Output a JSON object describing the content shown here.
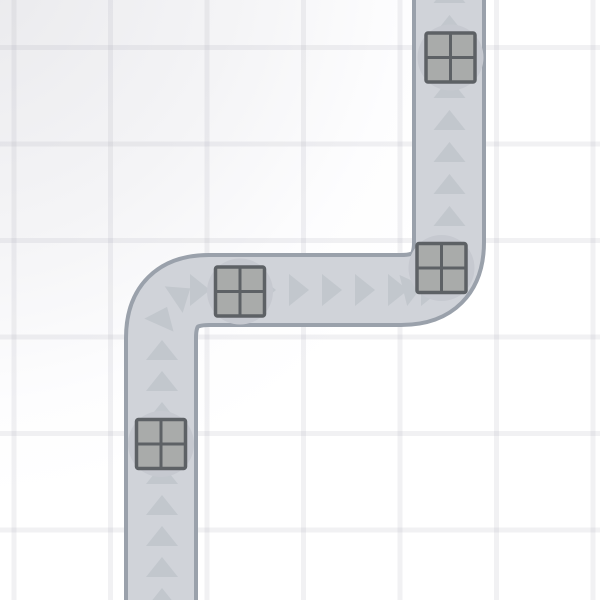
{
  "scene": {
    "title": "tower-defense-road-map",
    "width": 600,
    "height": 600,
    "colors": {
      "background": "#ffffff",
      "background_corner_tint": "#ebebee",
      "grid_line": "rgba(167,171,182,0.16)",
      "road_fill": "#d0d3d9",
      "road_border": "#9aa1ab",
      "arrow": "#c2c7cd",
      "pad_circle": "#c6c9d0",
      "crate_fill": "#a9abaa",
      "crate_border": "#5d6165"
    },
    "grid": {
      "offset_x": 14,
      "offset_y": 47.5,
      "spacing": 96.5,
      "line_width": 5
    },
    "road": {
      "centerline": "M 161 612 L 161 338 Q 161 290 209 290 L 401 290 Q 449 290 449 242 L 449 -12",
      "surface_width": 66,
      "border_width": 74,
      "corner_radius": 48,
      "flow": "up-right-up"
    },
    "arrows": {
      "base": 32,
      "height": 20,
      "items": [
        {
          "x": 162,
          "y": 598,
          "rot": 0
        },
        {
          "x": 162,
          "y": 567,
          "rot": 0
        },
        {
          "x": 162,
          "y": 536,
          "rot": 0
        },
        {
          "x": 162,
          "y": 505,
          "rot": 0
        },
        {
          "x": 162,
          "y": 474,
          "rot": 0
        },
        {
          "x": 162,
          "y": 443,
          "rot": 0
        },
        {
          "x": 162,
          "y": 412,
          "rot": 0
        },
        {
          "x": 162,
          "y": 381,
          "rot": 0
        },
        {
          "x": 162,
          "y": 350,
          "rot": 0
        },
        {
          "x": 163,
          "y": 316,
          "rot": 24
        },
        {
          "x": 182,
          "y": 294,
          "rot": 56
        },
        {
          "x": 200,
          "y": 290,
          "rot": 90
        },
        {
          "x": 233,
          "y": 290,
          "rot": 90
        },
        {
          "x": 266,
          "y": 290,
          "rot": 90
        },
        {
          "x": 299,
          "y": 290,
          "rot": 90
        },
        {
          "x": 332,
          "y": 290,
          "rot": 90
        },
        {
          "x": 365,
          "y": 290,
          "rot": 90
        },
        {
          "x": 398,
          "y": 290,
          "rot": 90
        },
        {
          "x": 431,
          "y": 290,
          "rot": 90
        },
        {
          "x": 413,
          "y": 288,
          "rot": 76
        },
        {
          "x": 440,
          "y": 271,
          "rot": 40
        },
        {
          "x": 449.5,
          "y": 248,
          "rot": 0
        },
        {
          "x": 449.5,
          "y": 216,
          "rot": 0
        },
        {
          "x": 449.5,
          "y": 184,
          "rot": 0
        },
        {
          "x": 449.5,
          "y": 152,
          "rot": 0
        },
        {
          "x": 449.5,
          "y": 120,
          "rot": 0
        },
        {
          "x": 449.5,
          "y": 88,
          "rot": 0
        },
        {
          "x": 449.5,
          "y": 57,
          "rot": 0
        },
        {
          "x": 449.5,
          "y": 25,
          "rot": 0
        },
        {
          "x": 449.5,
          "y": -7,
          "rot": 0
        }
      ]
    },
    "crates": {
      "size": 49,
      "pad_radius": 33,
      "outer_stroke": 3.5,
      "divider_stroke": 3,
      "items": [
        {
          "x": 161,
          "y": 444
        },
        {
          "x": 240,
          "y": 291.5
        },
        {
          "x": 441.5,
          "y": 268
        },
        {
          "x": 450.5,
          "y": 57.5
        }
      ]
    }
  }
}
